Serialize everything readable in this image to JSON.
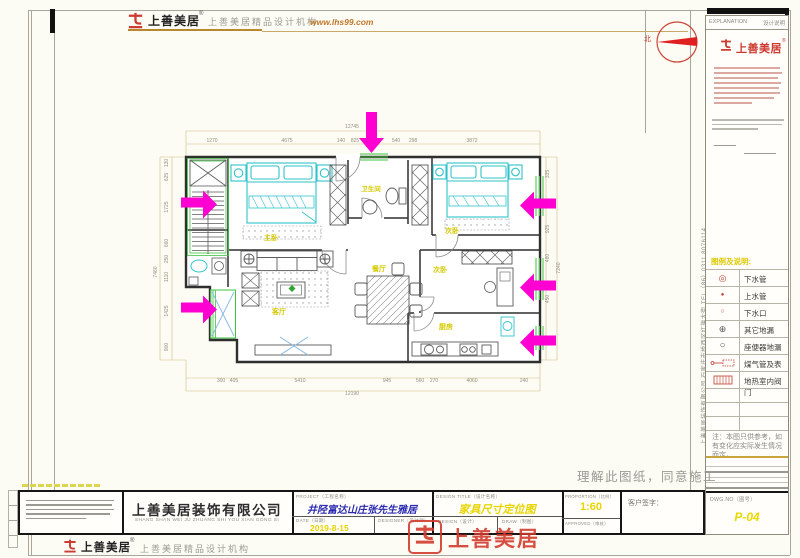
{
  "header": {
    "brand": "上善美居",
    "reg": "®",
    "tagline": "上善美居精品设计机构",
    "website": "www.lhs99.com"
  },
  "compass": {
    "north": "北"
  },
  "sidebar": {
    "bar_en": "EXPLANATION",
    "bar_cn": "设计说明",
    "brand": "上善美居",
    "reg": "®",
    "legend_title": "图例及说明:",
    "legend": [
      {
        "symbol": "double-circle",
        "label": "下水管"
      },
      {
        "symbol": "dot",
        "label": "上水管"
      },
      {
        "symbol": "small-circle",
        "label": "下水口"
      },
      {
        "symbol": "crossed-circle",
        "label": "其它地漏"
      },
      {
        "symbol": "circle",
        "label": "座便器地漏"
      },
      {
        "symbol": "gas-meter",
        "label": "煤气管及表"
      },
      {
        "symbol": "hatched-box",
        "label": "地热室内阀门"
      }
    ],
    "note": "注：本图只供参考，如有变化应实际发生情况而定。",
    "dwg_label": "DWG.NO（图号）",
    "dwg_no": "P-04"
  },
  "side_text": "上善美居装饰有限公司  石家庄市桥西区红旗大街  TEL（86）0311  8076114",
  "notes": {
    "agree": "理解此图纸，同意施工"
  },
  "titleblock": {
    "company": "上善美居装饰有限公司",
    "pinyin": "SHANG SHAN WEI JU ZHUANG SHI YOU XIAN GONG SI",
    "project_label": "PROJECT（工程名称）",
    "project": "井陉富达山庄张先生雅居",
    "date_label": "DATE（日期）",
    "date": "2019-8-15",
    "designer_label": "DESIGNER（设计师）",
    "title_label": "DESIGN.TITLE（设计名称）",
    "title": "家具尺寸定位图",
    "design_label": "DESIGN（设计）",
    "draw_label": "DRAW（制图）",
    "scale_label": "PROPORTION（比例）",
    "scale": "1:60",
    "approve_label": "APPROVED（审核）",
    "sign_label": "客户签字："
  },
  "stamp": {
    "text": "上善美居"
  },
  "footer": {
    "brand": "上善美居",
    "reg": "®",
    "tagline": "上善美居精品设计机构"
  },
  "plan": {
    "labels": {
      "master": "主卧",
      "bath": "卫生间",
      "bed2": "次卧",
      "living": "客厅",
      "dining": "餐厅",
      "bed3": "次卧",
      "kitchen": "厨房"
    },
    "dims": {
      "top_total": "12745",
      "top": [
        "1270",
        "4675",
        "140",
        "825",
        "370",
        "540",
        "298",
        "3872"
      ],
      "bottom": [
        "300",
        "405",
        "5410",
        "945",
        "560",
        "270",
        "4060",
        "240"
      ],
      "bottom_total": "12190",
      "left": [
        "130",
        "625",
        "1725",
        "660",
        "250",
        "1110",
        "1425",
        "900"
      ],
      "left_total": "7460",
      "right": [
        "335",
        "925",
        "480",
        "450",
        "280"
      ],
      "right_total": "7240"
    }
  },
  "colors": {
    "arrow_magenta": "#ff00d2",
    "window_green": "#3fc43f",
    "furniture_cyan": "#2fc3cb",
    "label_yellow": "#d6ca00",
    "brand_red": "#cc3a30",
    "value_yellow": "#e8d400",
    "project_blue": "#2a2ab0"
  }
}
